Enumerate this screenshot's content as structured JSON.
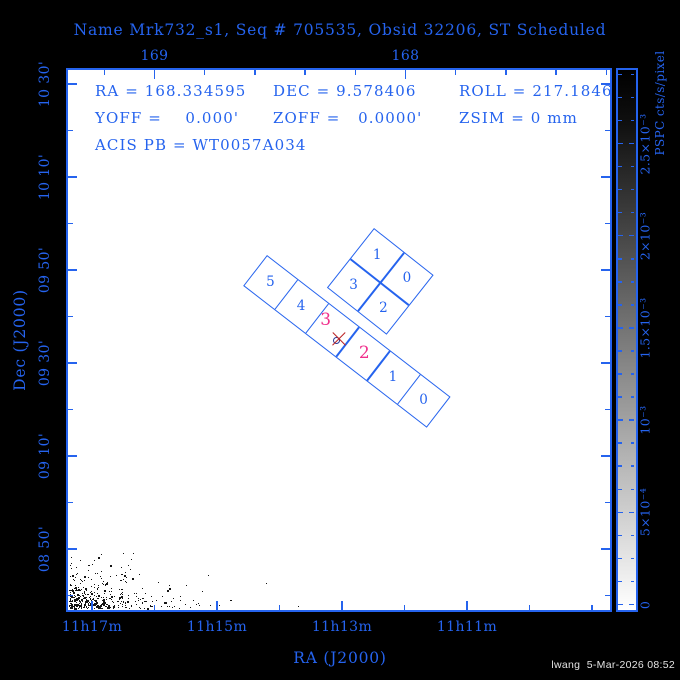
{
  "figure": {
    "title": "Name Mrk732_s1, Seq # 705535, Obsid 32206, ST Scheduled",
    "footer": "lwang  5-Mar-2026 08:52",
    "colors": {
      "accent_blue": "#2563ee",
      "highlight_pink": "#f0308c",
      "marker_red": "#bb2222",
      "circle_navy": "#283898",
      "background": "#000000",
      "plot_background": "#ffffff",
      "points_black": "#141414",
      "footer_gray": "#e4e4e4"
    }
  },
  "info_block": {
    "ra": "RA = 168.334595",
    "dec": "DEC = 9.578406",
    "roll": "ROLL = 217.1846",
    "yoff": "YOFF =    0.000'",
    "zoff": "ZOFF =   0.0000'",
    "zsim": "ZSIM = 0 mm",
    "acis_pb": "ACIS PB = WT0057A034"
  },
  "chart_data": {
    "type": "scatter",
    "title": "Name Mrk732_s1, Seq # 705535, Obsid 32206, ST Scheduled",
    "xlabel": "RA (J2000)",
    "ylabel": "Dec (J2000)",
    "target": {
      "name": "Mrk732_s1",
      "seq": "705535",
      "obsid": "32206",
      "status": "ST Scheduled",
      "ra_deg": 168.334595,
      "dec_deg": 9.578406,
      "roll_deg": 217.1846,
      "yoff_arcmin": 0.0,
      "zoff_arcmin": 0.0,
      "zsim_mm": 0,
      "acis_pb": "WT0057A034"
    },
    "xlim_deg": [
      169.35,
      167.17
    ],
    "ylim_deg": [
      8.62,
      10.56
    ],
    "grid": false,
    "x_axis_bottom": {
      "unit": "RA hours-minutes",
      "labels": [
        "11h17m",
        "11h15m",
        "11h13m",
        "11h11m"
      ],
      "px": [
        92,
        217,
        342,
        467
      ],
      "minor_px": [
        154.5,
        279.5,
        404.5,
        529.5,
        592
      ]
    },
    "x_axis_top": {
      "unit": "RA degrees",
      "labels": [
        "169",
        "168"
      ],
      "px": [
        154.5,
        405.5
      ],
      "minor_px": [
        104.3,
        204.7,
        254.9,
        305.1,
        355.3,
        455.7,
        505.9,
        556.1,
        606.3
      ]
    },
    "y_axis_left": {
      "unit": "Dec degrees arcmin",
      "labels": [
        "10 30'",
        "10 10'",
        "09 50'",
        "09 30'",
        "09 10'",
        "08 50'"
      ],
      "px": [
        84,
        177,
        270,
        363,
        456,
        549
      ],
      "minor_px": [
        130.5,
        223.5,
        316.5,
        409.5,
        502.5,
        595.5
      ]
    },
    "colorbar": {
      "label": "PSPC cts/s/pixel",
      "tick_labels": [
        "2.5×10⁻³",
        "2×10⁻³",
        "1.5×10⁻³",
        "10⁻³",
        "5×10⁻⁴",
        "0"
      ],
      "tick_px": [
        143.5,
        235.7,
        327.9,
        420.1,
        512.3,
        604.5
      ],
      "minor_step_px": 23.05,
      "minors_per_major": 4,
      "top_value": 0.0029,
      "bottom_value": 0,
      "top_color": "#000000",
      "bottom_color": "#ffffff"
    },
    "footprints": {
      "acis_i": {
        "name": "ACIS-I",
        "angle_deg": 38.3,
        "origin_px": [
          374,
          228
        ],
        "cell_px": 38,
        "grid": [
          [
            "1",
            "0"
          ],
          [
            "3",
            "2"
          ]
        ]
      },
      "acis_s": {
        "name": "ACIS-S",
        "angle_deg": 37.7,
        "origin_px": [
          267,
          255
        ],
        "cell_px": 38.7,
        "chips": [
          "5",
          "4",
          "3",
          "2",
          "1",
          "0"
        ],
        "highlighted_chips": [
          "3",
          "2"
        ]
      }
    },
    "aimpoint": {
      "x_px": 339,
      "y_px": 339,
      "circle_center_px": [
        336,
        340
      ]
    },
    "background_source": {
      "region": "bottom-left corner",
      "n_points": 430,
      "x_scale_px": 36,
      "y_scale_px": 13
    }
  }
}
